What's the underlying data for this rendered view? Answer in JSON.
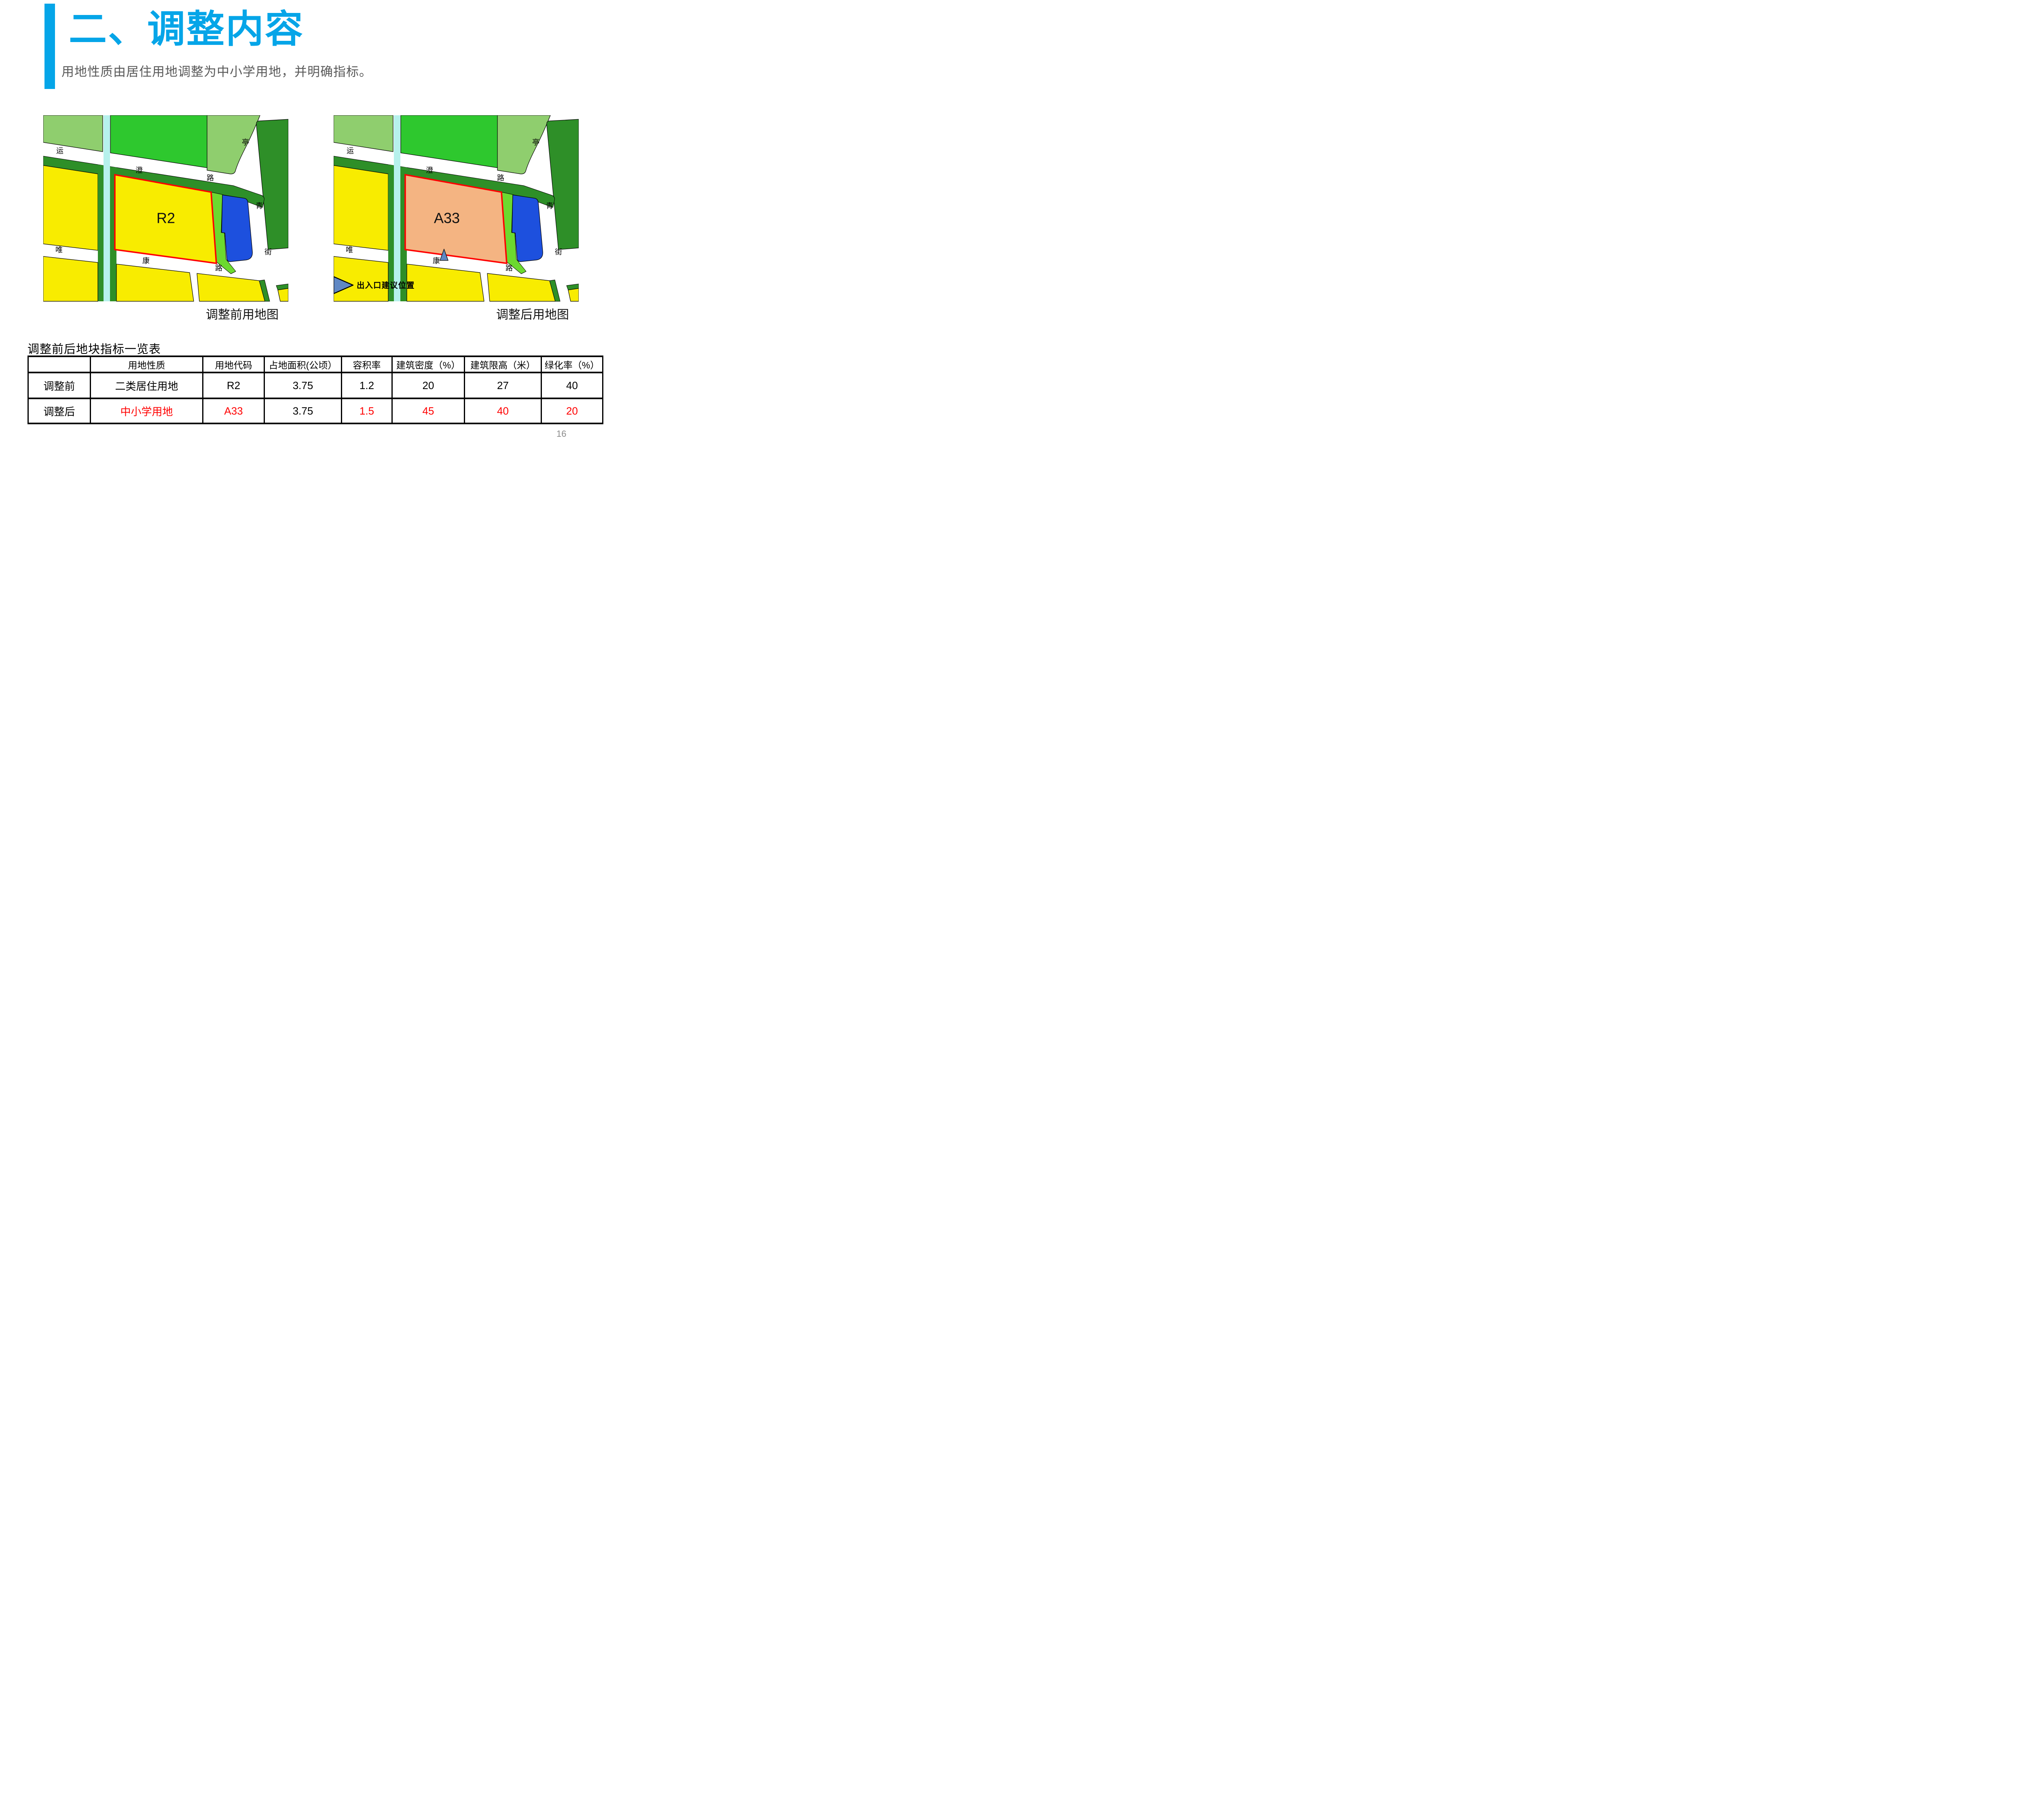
{
  "page": {
    "number": "16"
  },
  "header": {
    "title": "二、调整内容",
    "subtitle": "用地性质由居住用地调整为中小学用地，并明确指标。",
    "accent_color": "#05A5E8",
    "subtitle_color": "#595959"
  },
  "maps": {
    "colors": {
      "light_green": "#8FCE6E",
      "bright_green": "#2EC82E",
      "dark_green": "#2E8F28",
      "canal": "#B6F1EC",
      "yellow": "#F8EC00",
      "strip_green": "#6CD92F",
      "blue_parcel": "#1D50DE",
      "marker_blue": "#6088C4",
      "parcel_outline": "#FF0000",
      "block_outline": "#000000",
      "label_color": "#000000"
    },
    "road_labels": {
      "yuncheng": [
        "运",
        "澄",
        "路"
      ],
      "tingqing": [
        "亭",
        "青",
        "街"
      ],
      "weikang": [
        "唯",
        "康",
        "路"
      ]
    },
    "before": {
      "parcel_label": "R2",
      "caption": "调整前用地图"
    },
    "after": {
      "parcel_label": "A33",
      "caption": "调整后用地图",
      "legend_label": "出入口建议位置"
    }
  },
  "table": {
    "title": "调整前后地块指标一览表",
    "headers": [
      "",
      "用地性质",
      "用地代码",
      "占地面积(公顷）",
      "容积率",
      "建筑密度（%）",
      "建筑限高（米）",
      "绿化率（%）"
    ],
    "rows": [
      {
        "label": "调整前",
        "cells": [
          "二类居住用地",
          "R2",
          "3.75",
          "1.2",
          "20",
          "27",
          "40"
        ],
        "red": [
          false,
          false,
          false,
          false,
          false,
          false,
          false
        ]
      },
      {
        "label": "调整后",
        "cells": [
          "中小学用地",
          "A33",
          "3.75",
          "1.5",
          "45",
          "40",
          "20"
        ],
        "red": [
          true,
          true,
          false,
          true,
          true,
          true,
          true
        ]
      }
    ],
    "highlight_color": "#FF0000"
  }
}
